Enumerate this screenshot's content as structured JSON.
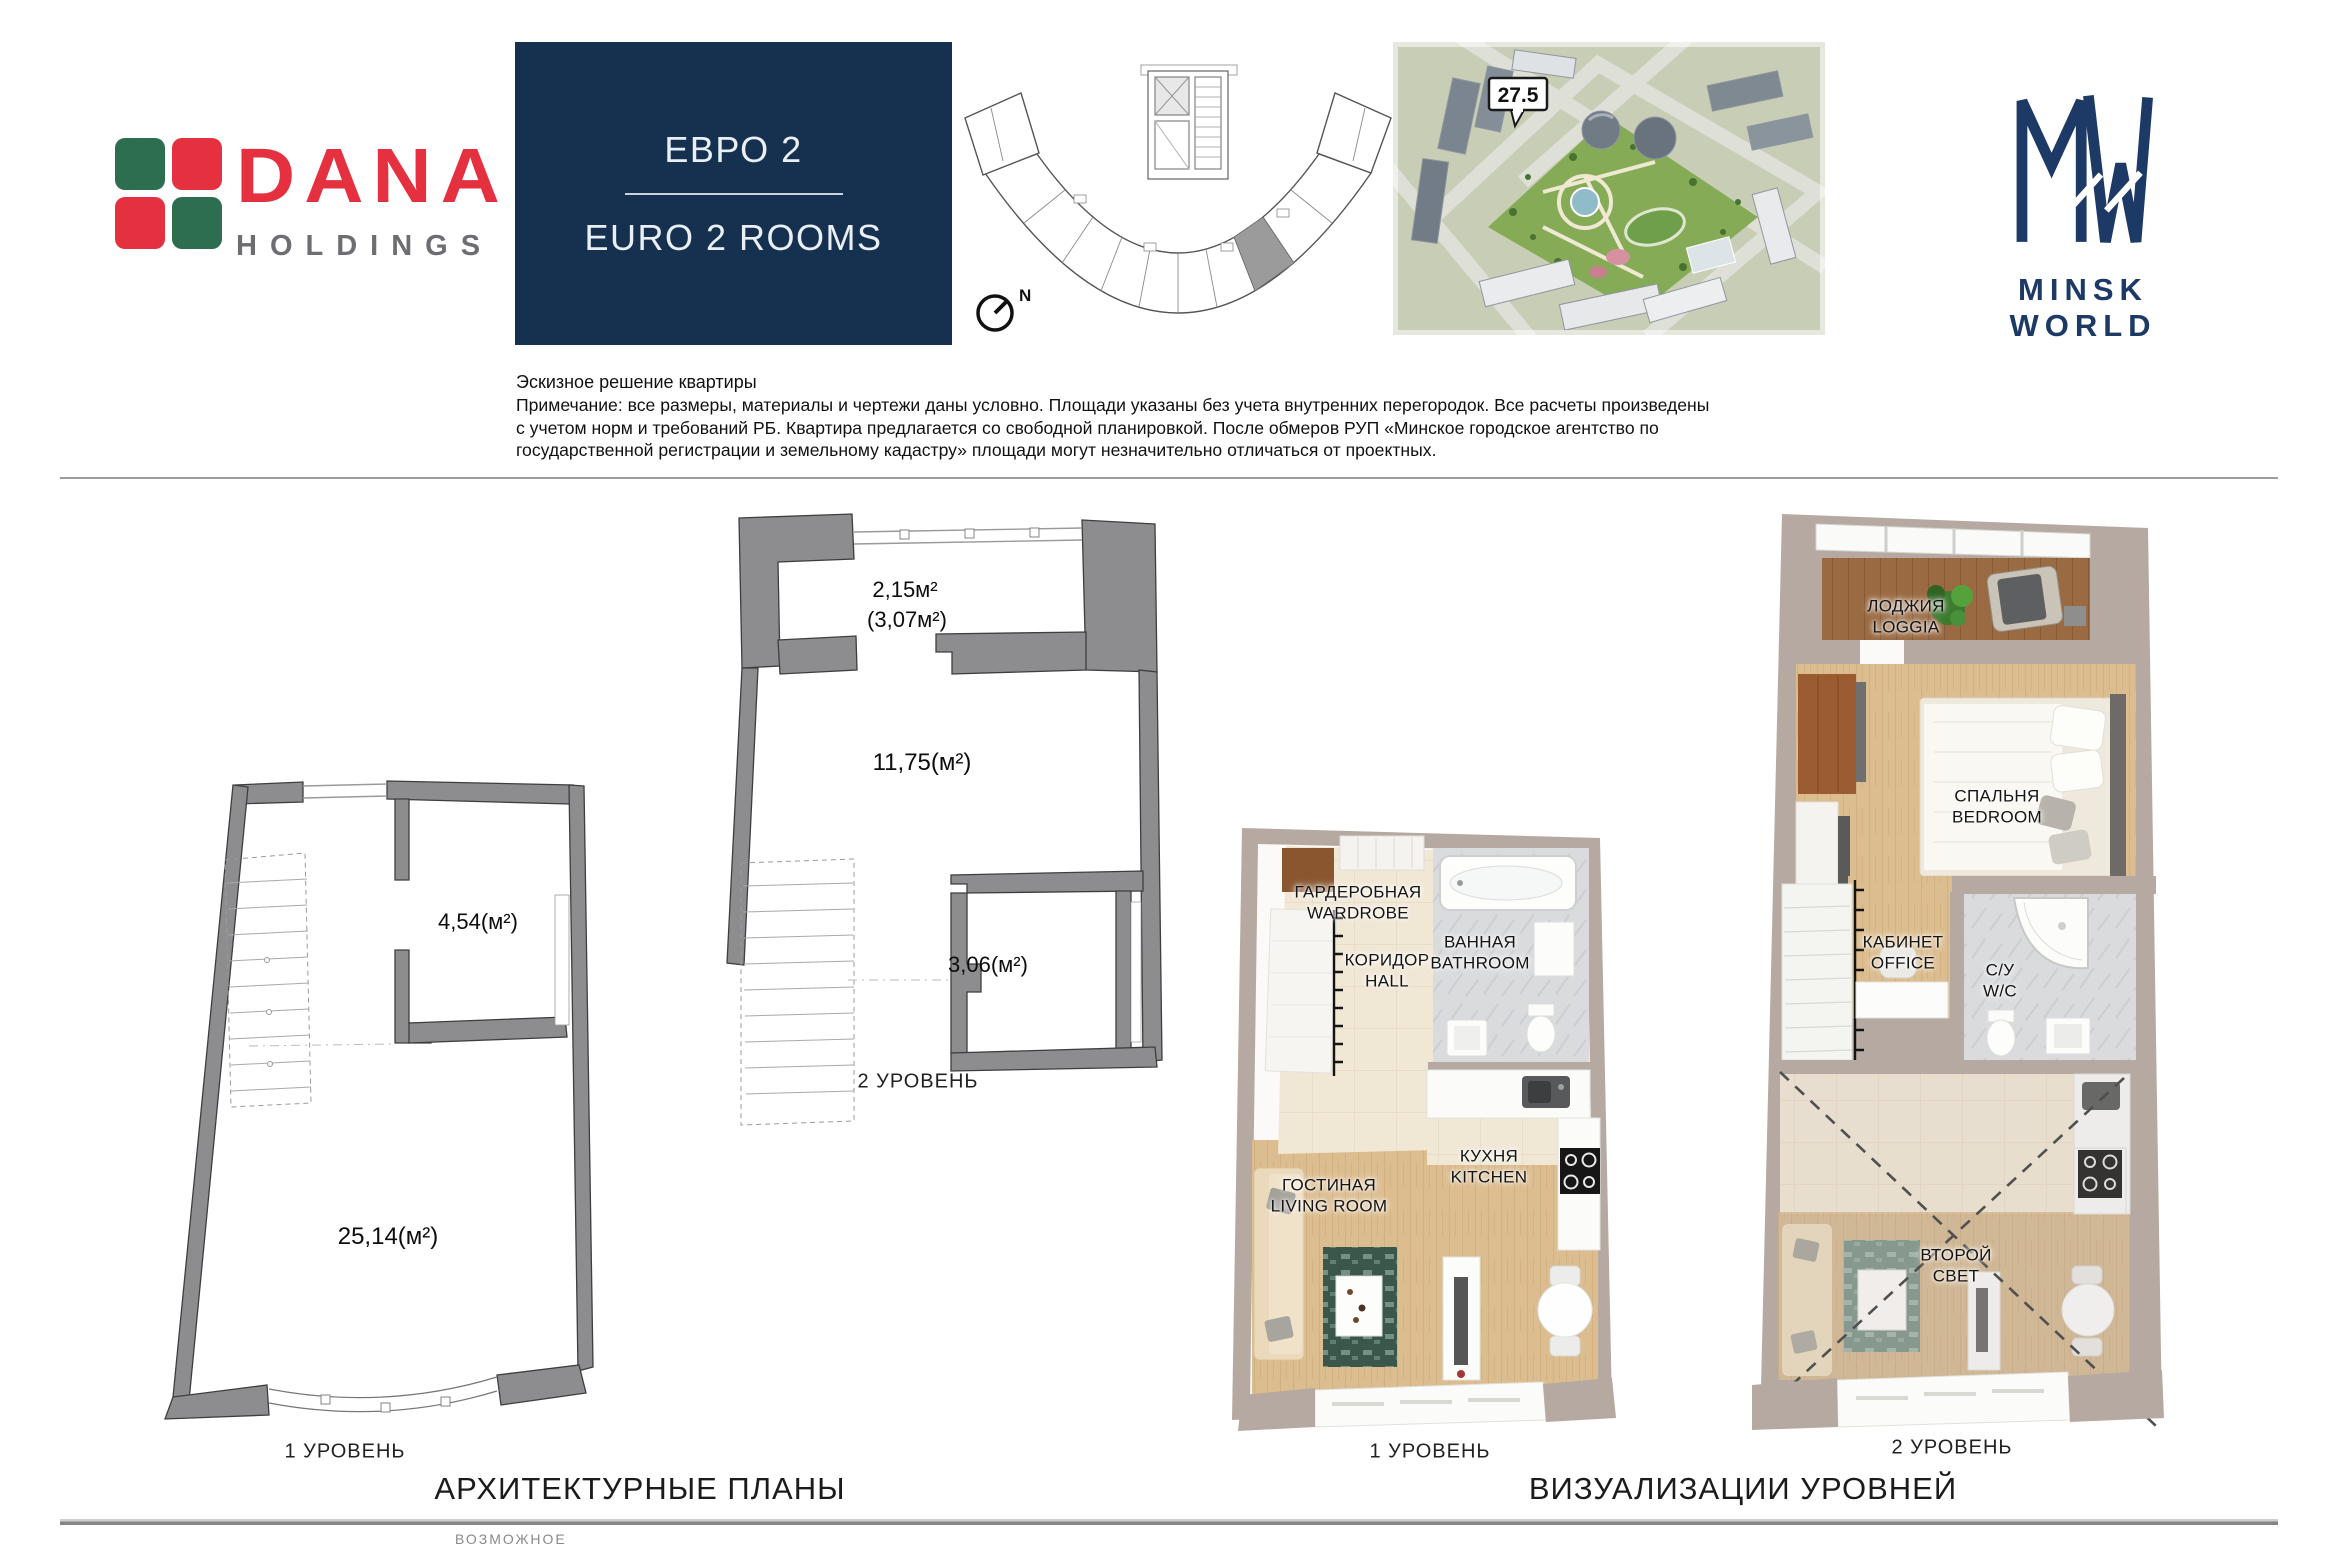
{
  "brand": {
    "dana": {
      "name": "DANA",
      "sub": "HOLDINGS",
      "red": "#e5303f",
      "green": "#2c6e4f",
      "gray": "#6d6e71"
    },
    "minsk_world": {
      "monogram_icon": "mw-monogram",
      "name": "MINSK WORLD",
      "navy": "#1d3a66"
    }
  },
  "title_box": {
    "ru": "ЕВРО 2",
    "en": "EURO 2 ROOMS",
    "bg": "#16314f"
  },
  "site_plan": {
    "compass": "N"
  },
  "aerial": {
    "callout": "27.5"
  },
  "disclaimer": {
    "title": "Эскизное решение квартиры",
    "lines": [
      "Примечание: все размеры, материалы и чертежи даны условно. Площади указаны без учета внутренних перегородок. Все расчеты произведены",
      "с учетом норм и требований РБ. Квартира предлагается со свободной планировкой. После обмеров РУП «Минское городское агентство по",
      "государственной регистрации и земельному кадастру» площади могут незначительно отличаться от проектных."
    ]
  },
  "plans": {
    "heading": "АРХИТЕКТУРНЫЕ ПЛАНЫ",
    "level1": {
      "label": "1 УРОВЕНЬ",
      "area_room": "4,54(м²)",
      "area_main": "25,14(м²)"
    },
    "level2": {
      "label": "2 УРОВЕНЬ",
      "area_loggia": "2,15м²",
      "area_loggia_full": "(3,07м²)",
      "area_main": "11,75(м²)",
      "area_room": "3,06(м²)"
    }
  },
  "visualizations": {
    "heading": "ВИЗУАЛИЗАЦИИ УРОВНЕЙ",
    "level1": {
      "label": "1 УРОВЕНЬ",
      "rooms": {
        "wardrobe": {
          "ru": "ГАРДЕРОБНАЯ",
          "en": "WARDROBE"
        },
        "hall": {
          "ru": "КОРИДОР",
          "en": "HALL"
        },
        "bathroom": {
          "ru": "ВАННАЯ",
          "en": "BATHROOM"
        },
        "kitchen": {
          "ru": "КУХНЯ",
          "en": "KITCHEN"
        },
        "living": {
          "ru": "ГОСТИНАЯ",
          "en": "LIVING ROOM"
        }
      }
    },
    "level2": {
      "label": "2 УРОВЕНЬ",
      "rooms": {
        "loggia": {
          "ru": "ЛОДЖИЯ",
          "en": "LOGGIA"
        },
        "bedroom": {
          "ru": "СПАЛЬНЯ",
          "en": "BEDROOM"
        },
        "office": {
          "ru": "КАБИНЕТ",
          "en": "OFFICE"
        },
        "wc": {
          "ru": "С/У",
          "en": "W/C"
        },
        "void": {
          "l1": "ВТОРОЙ",
          "l2": "СВЕТ"
        }
      }
    }
  },
  "footer": {
    "truncated": "ВОЗМОЖНОЕ"
  }
}
